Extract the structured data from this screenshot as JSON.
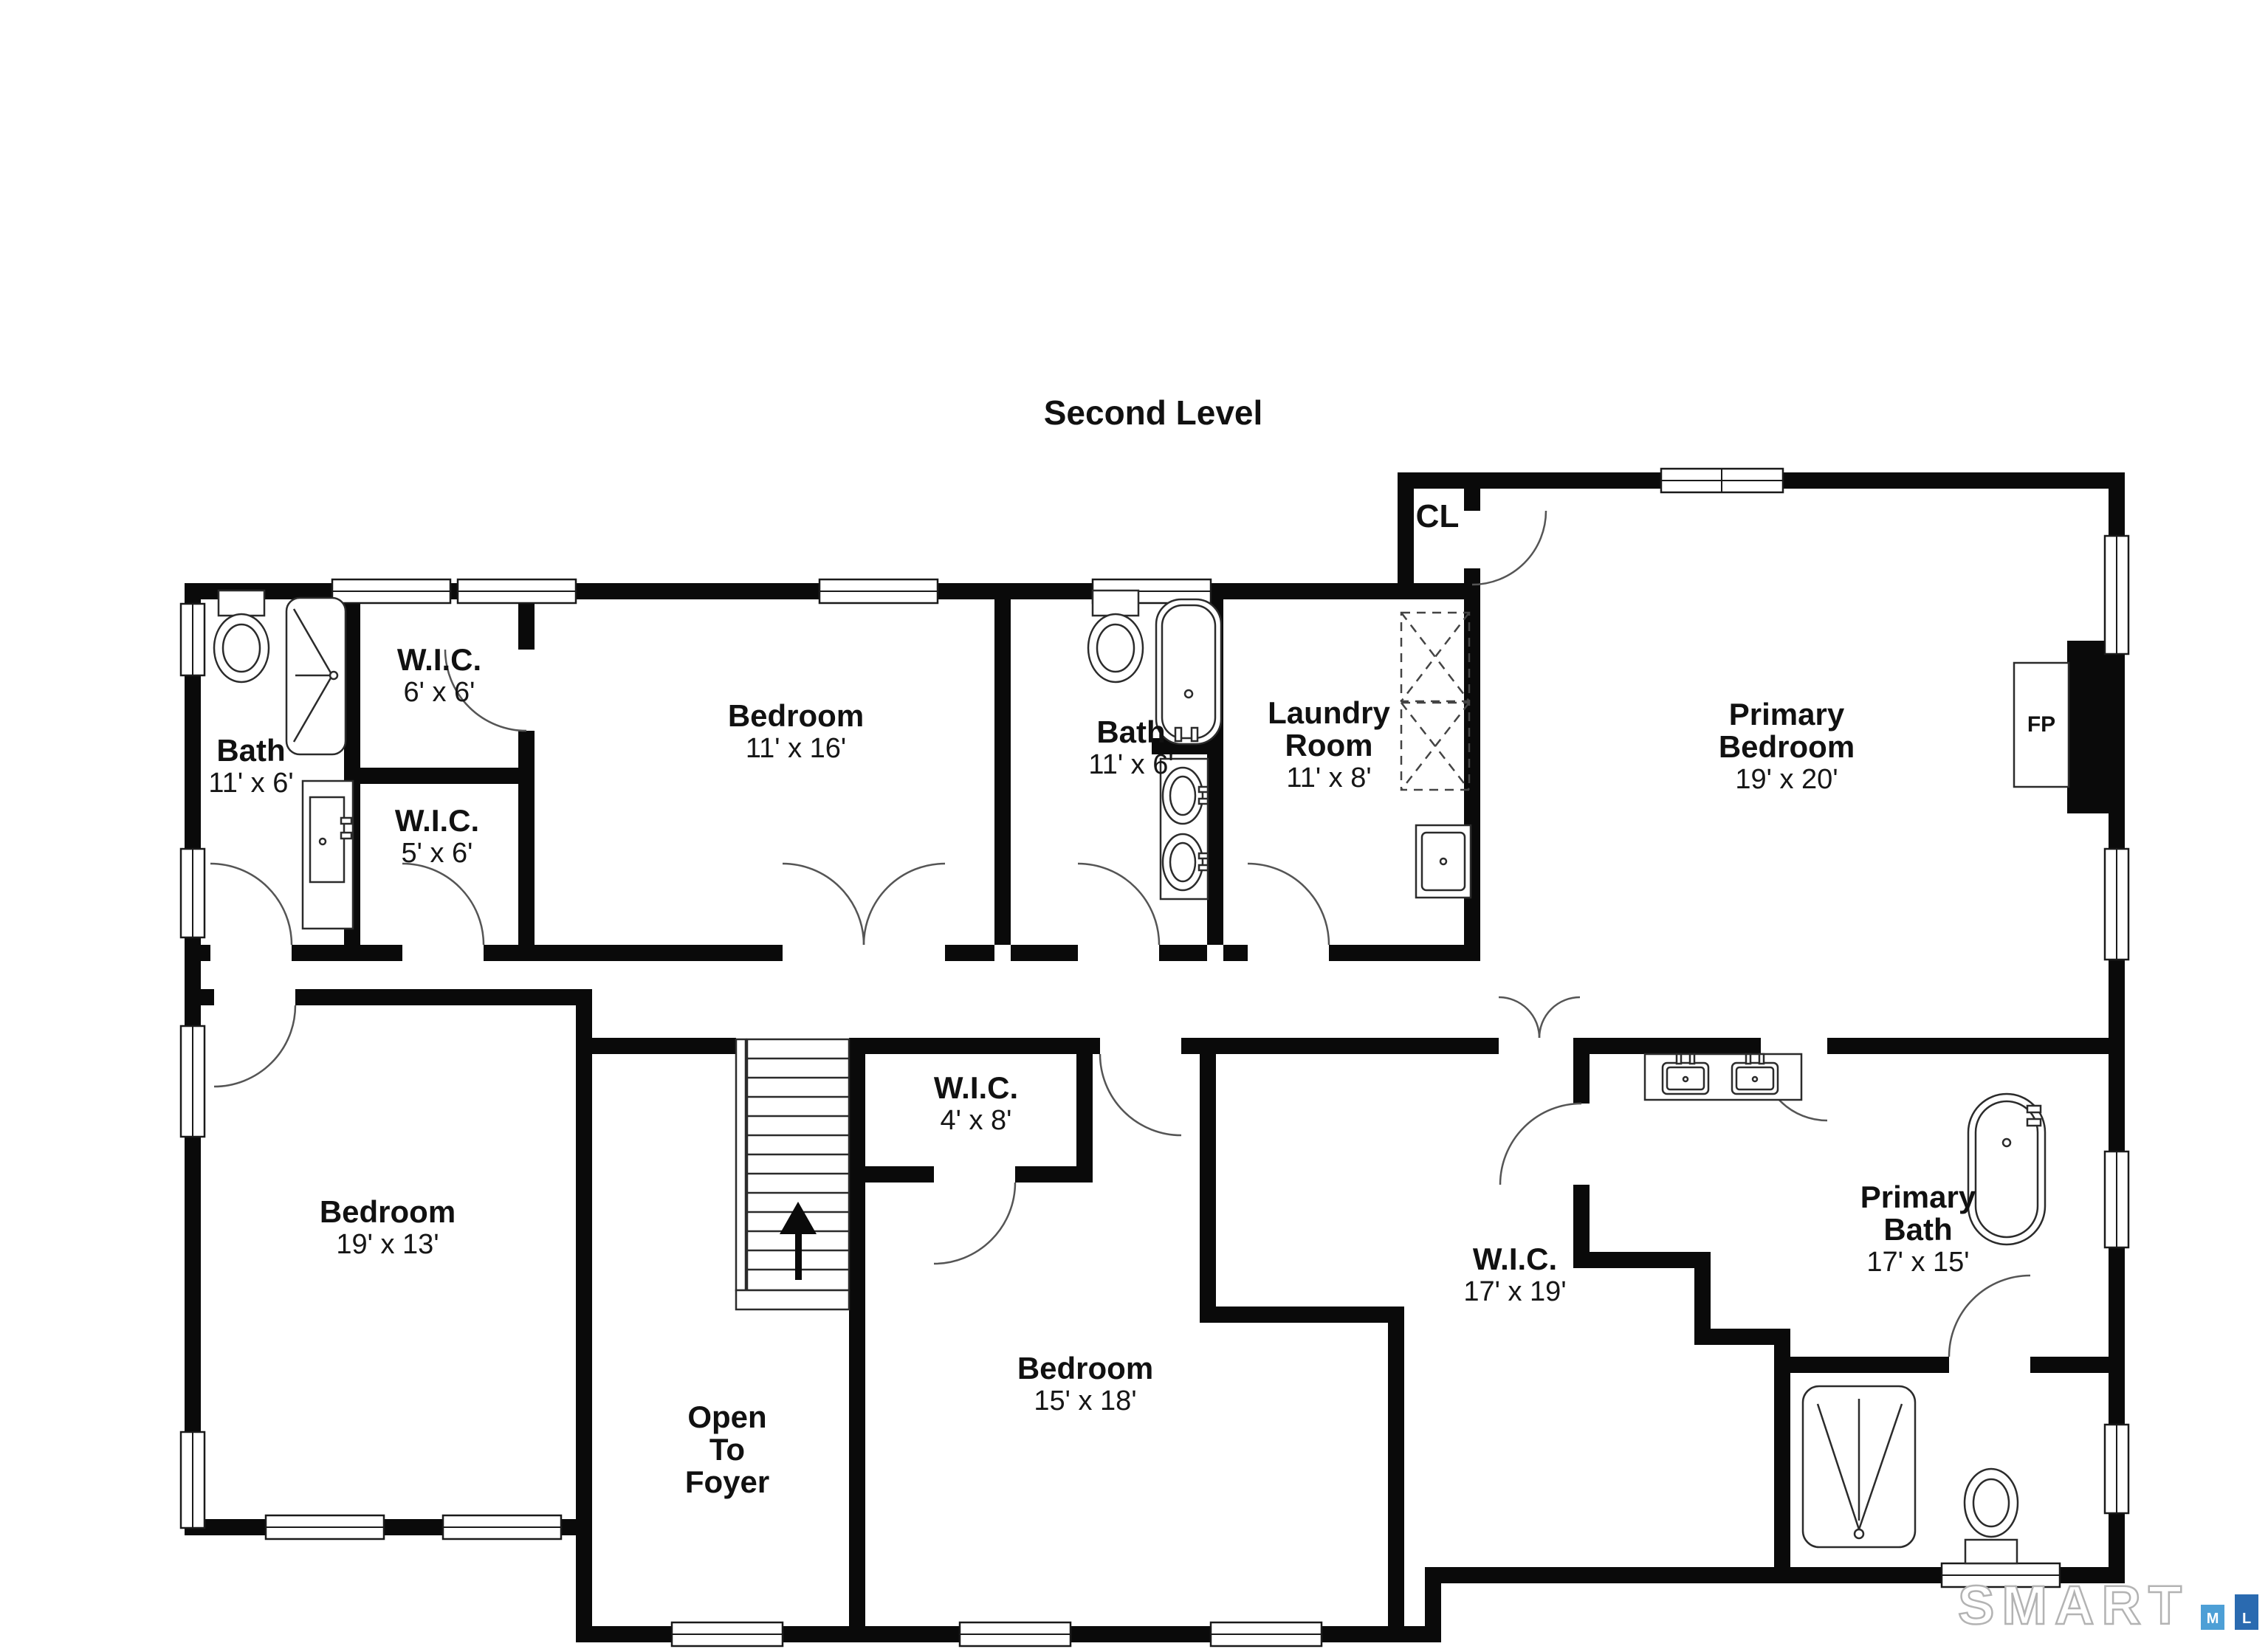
{
  "title": "Second Level",
  "rooms": {
    "bath1": {
      "name": "Bath",
      "dims": "11' x 6'"
    },
    "wic6": {
      "name": "W.I.C.",
      "dims": "6' x 6'"
    },
    "wic5": {
      "name": "W.I.C.",
      "dims": "5' x 6'"
    },
    "bedroom11": {
      "name": "Bedroom",
      "dims": "11' x 16'"
    },
    "bath2": {
      "name": "Bath",
      "dims": "11' x 6'"
    },
    "laundry": {
      "line1": "Laundry",
      "line2": "Room",
      "dims": "11' x 8'"
    },
    "closet": {
      "name": "CL"
    },
    "primary_bedroom": {
      "line1": "Primary",
      "line2": "Bedroom",
      "dims": "19' x 20'"
    },
    "fireplace": {
      "name": "FP"
    },
    "bedroom19": {
      "name": "Bedroom",
      "dims": "19' x 13'"
    },
    "wic4": {
      "name": "W.I.C.",
      "dims": "4' x 8'"
    },
    "foyer": {
      "line1": "Open",
      "line2": "To",
      "line3": "Foyer"
    },
    "bedroom15": {
      "name": "Bedroom",
      "dims": "15' x 18'"
    },
    "wic17": {
      "name": "W.I.C.",
      "dims": "17' x 19'"
    },
    "primary_bath": {
      "line1": "Primary",
      "line2": "Bath",
      "dims": "17' x 15'"
    }
  },
  "logo": {
    "brand": "SMART",
    "mls": [
      "M",
      "L",
      "S"
    ],
    "colors": {
      "m_box": "#4d9fd6",
      "l_box": "#2a6ab0",
      "s_box": "#2a556e",
      "brand_outline": "#b3b3b3"
    }
  },
  "colors": {
    "walls": "#0a0a0a",
    "background": "#ffffff"
  },
  "fixtures": [
    "toilet",
    "shower",
    "vanity-sink",
    "bathtub",
    "washer-dryer",
    "utility-sink",
    "double-vanity",
    "freestanding-tub",
    "fireplace",
    "stairs-up-arrow",
    "window",
    "door-swing"
  ]
}
